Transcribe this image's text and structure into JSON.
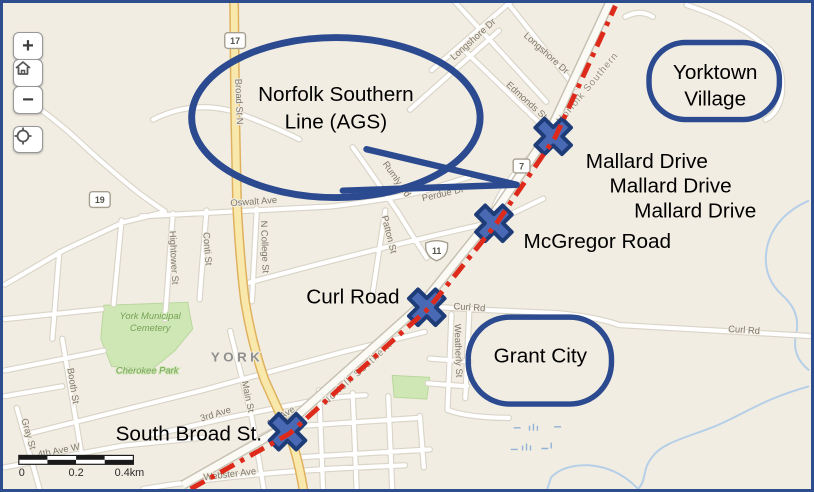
{
  "controls": {
    "zoom_in_label": "+",
    "zoom_out_label": "−"
  },
  "scale_bar": {
    "tick_0": "0",
    "tick_mid": "0.2",
    "tick_end": "0.4km"
  },
  "callouts": {
    "bubble_line1": "Norfolk Southern",
    "bubble_line2": "Line (AGS)",
    "yorktown_line1": "Yorktown",
    "yorktown_line2": "Village",
    "grant_city": "Grant City",
    "crossings": [
      {
        "label": "Mallard Drive"
      },
      {
        "label": "Mallard Drive"
      },
      {
        "label": "Mallard Drive"
      },
      {
        "label": "McGregor Road"
      },
      {
        "label": "Curl Road"
      },
      {
        "label": "South Broad St."
      }
    ]
  },
  "basemap": {
    "city": "YORK",
    "cemetery_line1": "York Municipal",
    "cemetery_line2": "Cemetery",
    "park": "Cherokee Park",
    "railroad": "Norfolk Southern",
    "shields": {
      "route17": "17",
      "route19": "19",
      "route7": "7",
      "route11": "11"
    },
    "streets": {
      "longshore_a": "Longshore Dr",
      "longshore_b": "Longshore Dr",
      "edmonds": "Edmonds St",
      "broad_st_n": "Broad St N",
      "oswalt": "Oswalt Ave",
      "rumly": "Rumly Rd",
      "perdue": "Perdue Dr",
      "patton": "Patton St",
      "n_college": "N College St",
      "conti": "Conti St",
      "hightower": "Hightower St",
      "curl_rd_a": "Curl Rd",
      "curl_rd_b": "Curl Rd",
      "weatherly": "Weatherly St",
      "main": "Main St",
      "third_ave": "3rd Ave",
      "first_ave": "1st Ave",
      "webster": "Webster Ave",
      "fourth_ave": "4th Ave W",
      "booth": "Booth St",
      "gray": "Gray St"
    }
  },
  "colors": {
    "annotation_blue": "#2b4a8f",
    "marker_fill": "#4a69b4",
    "railroad_red": "#de2a1b",
    "land": "#f2ede2",
    "road_yellow": "#f8e8ac",
    "park_green": "#cfe7b5",
    "water_blue": "#b5cfe8"
  }
}
